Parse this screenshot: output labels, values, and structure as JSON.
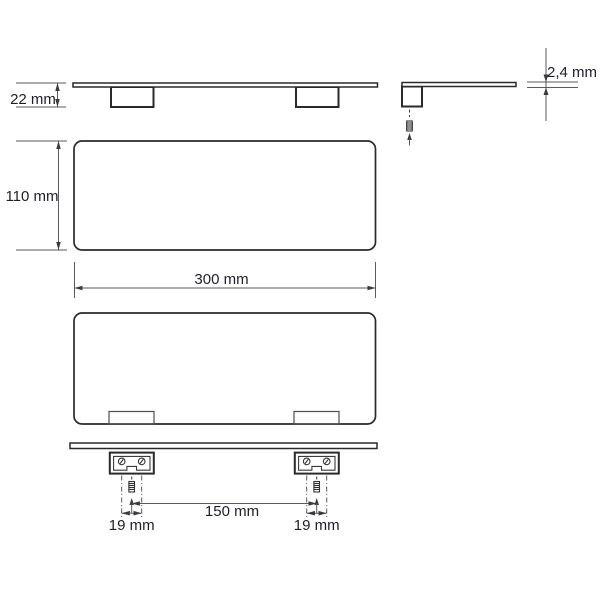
{
  "drawing": {
    "dimension_labels": {
      "height": "22 mm",
      "thickness": "2,4 mm",
      "depth": "110 mm",
      "width": "300 mm",
      "mounting_spacing": "150 mm",
      "hole_spacing_left": "19 mm",
      "hole_spacing_right": "19 mm"
    },
    "colors": {
      "background": "#ffffff",
      "outline": "#2a2a2a",
      "dimension_line": "#5a5a5a",
      "text": "#1e1e28"
    }
  }
}
